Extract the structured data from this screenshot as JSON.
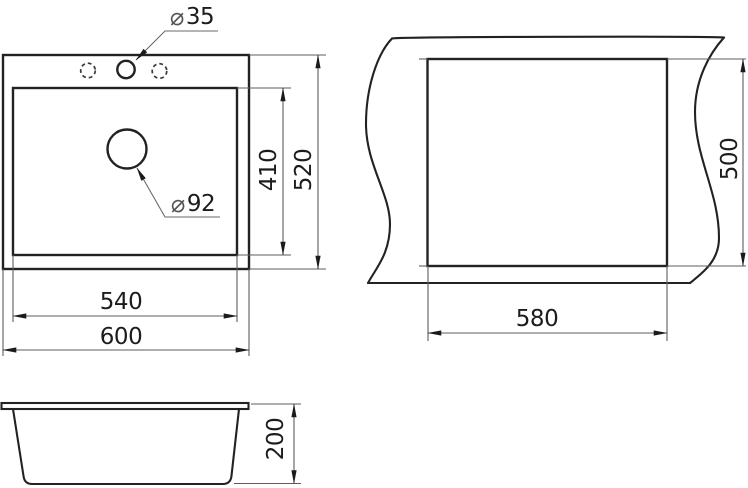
{
  "title": "Sink installation drawing",
  "colors": {
    "line": "#222222",
    "dimension_line": "#5d5d5d",
    "text": "#1c1c1c",
    "background": "#ffffff"
  },
  "views": {
    "plan": {
      "faucet_hole": {
        "symbol": "⌀",
        "value": "35"
      },
      "drain_hole": {
        "symbol": "⌀",
        "value": "92"
      },
      "dims": {
        "bowl_depth": "410",
        "overall_depth": "520",
        "bowl_width": "540",
        "overall_width": "600"
      }
    },
    "cutout": {
      "dims": {
        "depth": "500",
        "width": "580"
      }
    },
    "profile": {
      "dims": {
        "height": "200"
      }
    }
  }
}
